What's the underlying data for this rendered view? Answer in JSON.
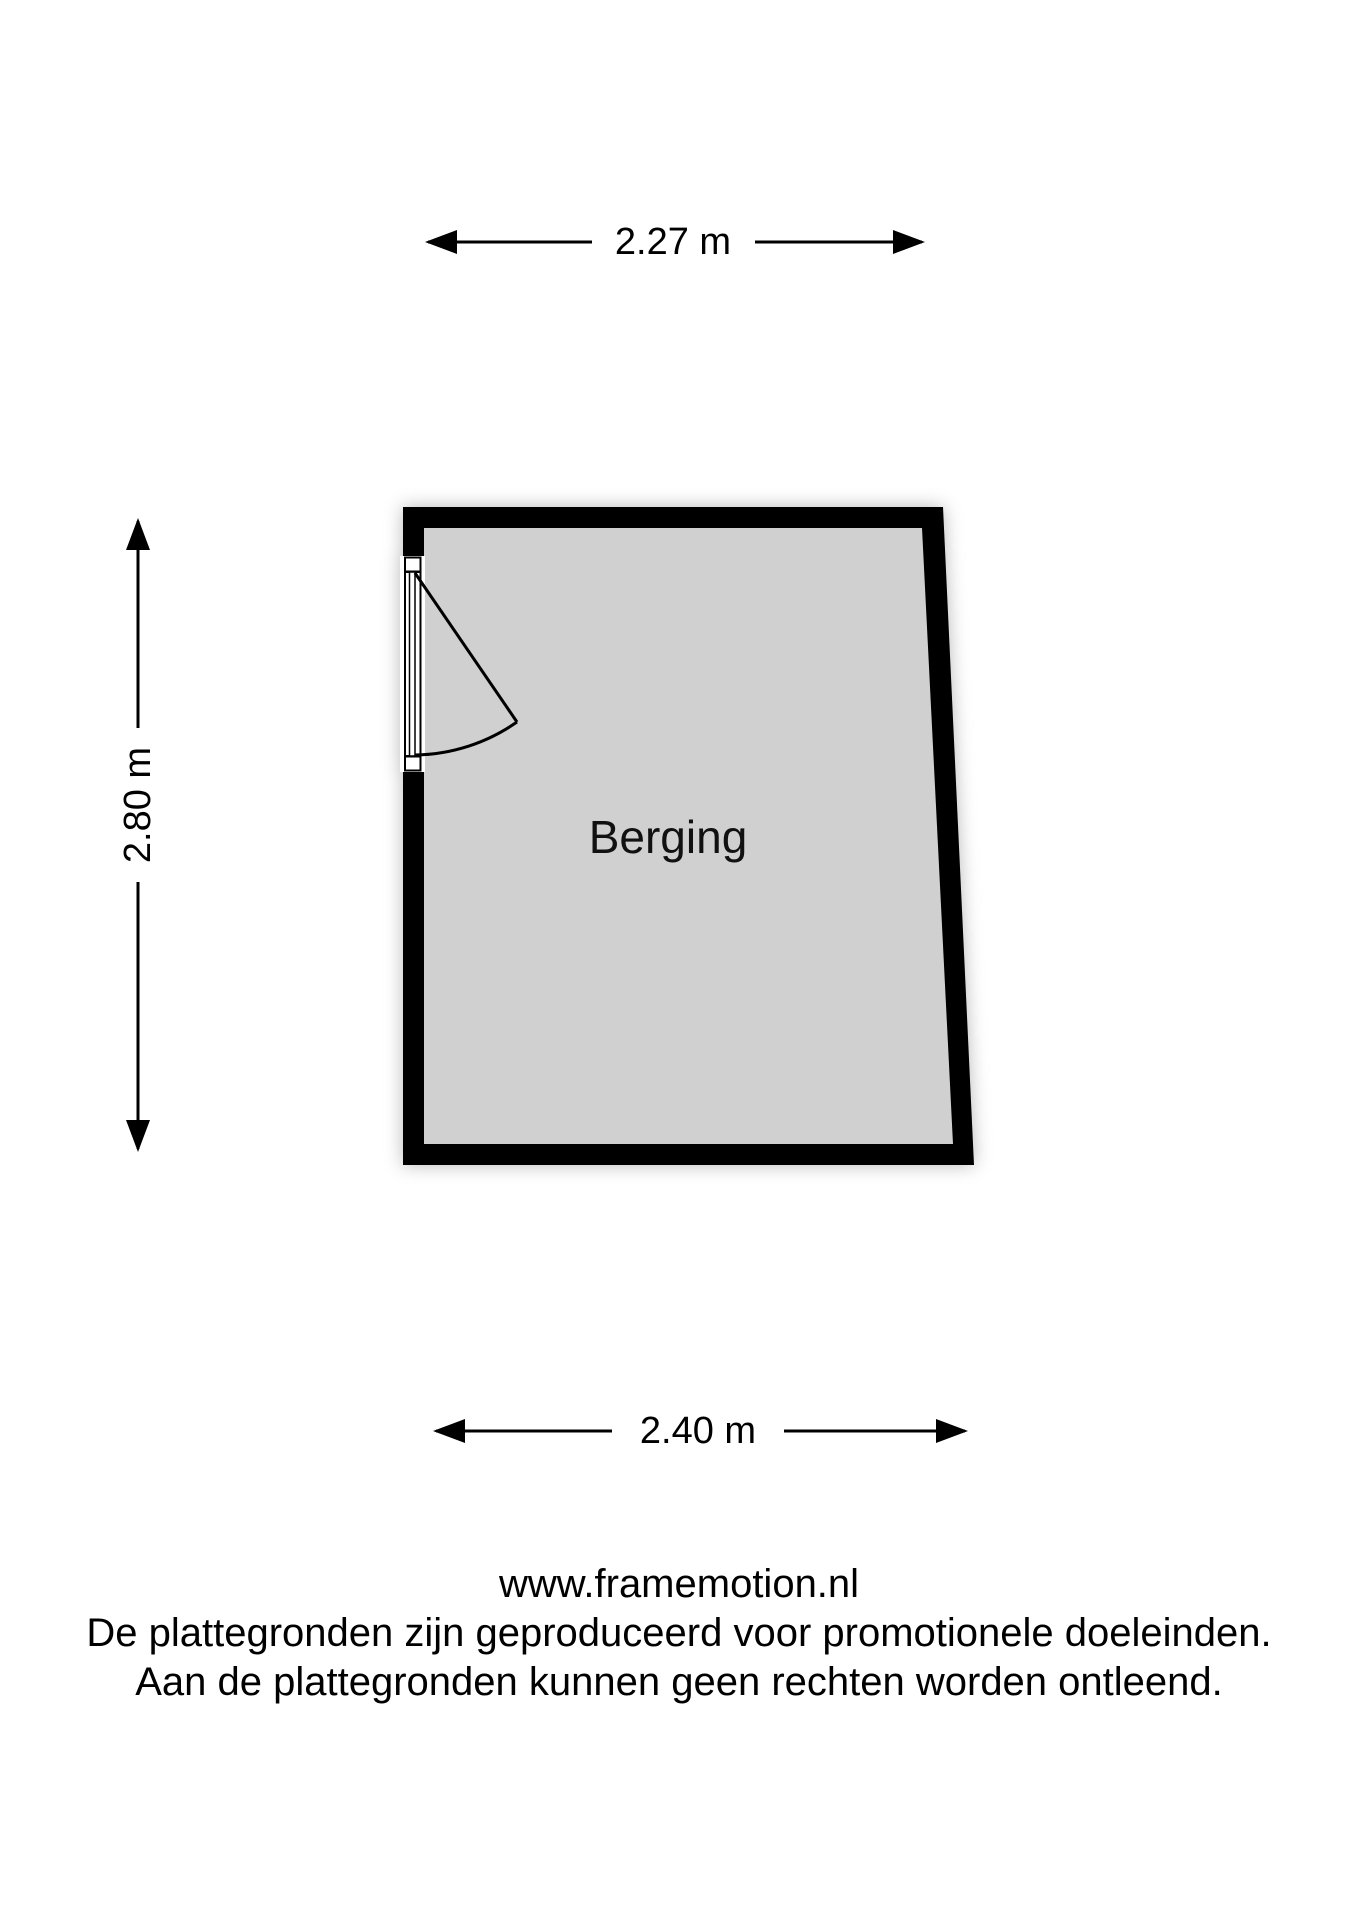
{
  "floorplan": {
    "room_label": "Berging",
    "dimensions": {
      "top": "2.27 m",
      "left": "2.80 m",
      "bottom": "2.40 m"
    }
  },
  "footer": {
    "website": "www.framemotion.nl",
    "disclaimer_line1": "De plattegronden zijn geproduceerd voor promotionele doeleinden.",
    "disclaimer_line2": "Aan de plattegronden kunnen geen rechten worden ontleend."
  },
  "colors": {
    "wall": "#000000",
    "floor": "#d0d0d0",
    "background": "#ffffff"
  }
}
